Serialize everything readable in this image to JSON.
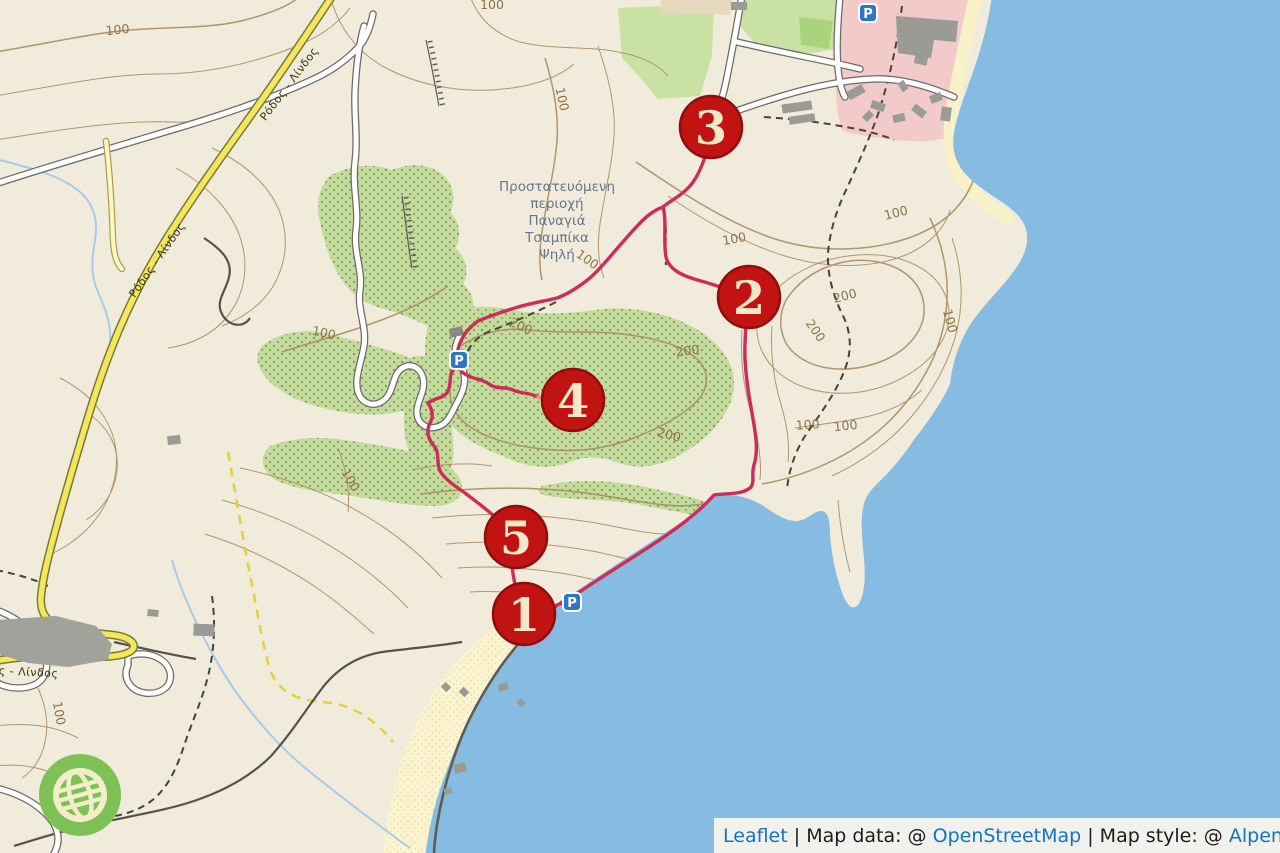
{
  "labels": {
    "protected_area_lines": [
      "Προστατευόμενη",
      "περιοχή",
      "Παναγιά",
      "Τσαμπίκα",
      "Ψηλή"
    ],
    "road_name": "Ρόδος - Λίνδος"
  },
  "markers": [
    {
      "number": "1"
    },
    {
      "number": "2"
    },
    {
      "number": "3"
    },
    {
      "number": "4"
    },
    {
      "number": "5"
    }
  ],
  "parking": {
    "label": "P"
  },
  "contour_labels": [
    "100",
    "100",
    "100",
    "100",
    "100",
    "100",
    "200",
    "200",
    "100",
    "100",
    "100",
    "200",
    "200",
    "200",
    "100",
    "100",
    "100"
  ],
  "attribution": {
    "leaflet": "Leaflet",
    "separator": " | ",
    "map_data_prefix": "Map data: @ ",
    "openstreetmap": "OpenStreetMap",
    "map_style_prefix": "Map style: @ ",
    "alpenkarte": "Alpenkarte"
  },
  "colors": {
    "water": "#86bce1",
    "land": "#f0ebdb",
    "forest": "#c3db9c",
    "field_green": "#c9e2a4",
    "bright_green": "#a9d47b",
    "residential_pink": "#f2caca",
    "sand": "#fbf4d2",
    "route": "#ce2b5b",
    "marker_red": "#c21313",
    "marker_text": "#f3e9c8",
    "contour_brown": "#ab8c5f",
    "yellow_road": "#f4e75f",
    "parking_blue": "#2f76c8",
    "logo_green": "#7ec154",
    "link_blue": "#1474bd"
  }
}
